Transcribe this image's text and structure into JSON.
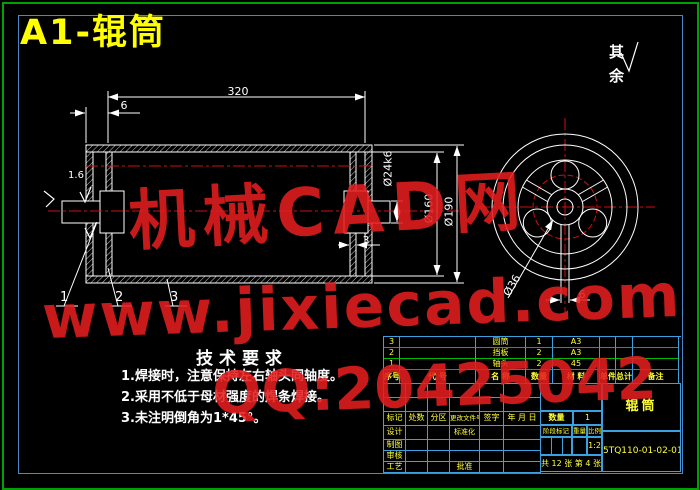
{
  "title": "A1-辊筒",
  "surface_note": {
    "label": "其余"
  },
  "tech_requirements": {
    "heading": "技术要求",
    "items": [
      "1.焊接时，注意保持左右轴头同轴度。",
      "2.采用不低于母材强度的焊条焊接。",
      "3.未注明倒角为1*45°。"
    ]
  },
  "dimensions": {
    "length": "320",
    "end_offset": "6",
    "shaft_dia": "Ø24k6",
    "inner_dia": "Ø160",
    "outer_dia": "Ø190",
    "plate_thickness": "3",
    "hub_dia": "Ø36",
    "spoke_width": "6",
    "roughness": "1.6"
  },
  "balloons": [
    "1",
    "2",
    "3"
  ],
  "bom": {
    "headers": [
      "序号",
      "代 号",
      "名 称",
      "数量",
      "材 料",
      "单件",
      "总计",
      "备注"
    ],
    "rows": [
      [
        "3",
        "",
        "圆筒",
        "1",
        "A3"
      ],
      [
        "2",
        "",
        "挡板",
        "2",
        "A3"
      ],
      [
        "1",
        "",
        "轴头",
        "2",
        "45"
      ]
    ]
  },
  "title_block": {
    "revision_headers": [
      "标记",
      "处数",
      "分区",
      "更改文件号",
      "签字",
      "年 月 日"
    ],
    "roles": [
      "设计",
      "制图",
      "审核",
      "工艺"
    ],
    "standardization": "标准化",
    "approval": "批准",
    "quantity_label": "数量",
    "quantity": "1",
    "stage_label": "阶段标记",
    "weight_label": "重量",
    "scale_label": "比例",
    "scale": "1:2",
    "sheet_info": "共 12 张 第 4 张",
    "part_name": "辊筒",
    "drawing_number": "5TQ110-01-02-01"
  },
  "watermark": {
    "line1": "机械CAD网",
    "line2": "www.jixiecad.com",
    "line3": "QQ:20425042"
  },
  "colors": {
    "background": "#000000",
    "line_white": "#ffffff",
    "centerline_red": "#cc1111",
    "table_green": "#00bb00",
    "table_blue": "#3aa0e0",
    "text_yellow": "#ffff33",
    "watermark_red": "#e41e1e",
    "border_green": "#00a000",
    "border_blue": "#4a86c8",
    "title_yellow": "#ffff00"
  }
}
